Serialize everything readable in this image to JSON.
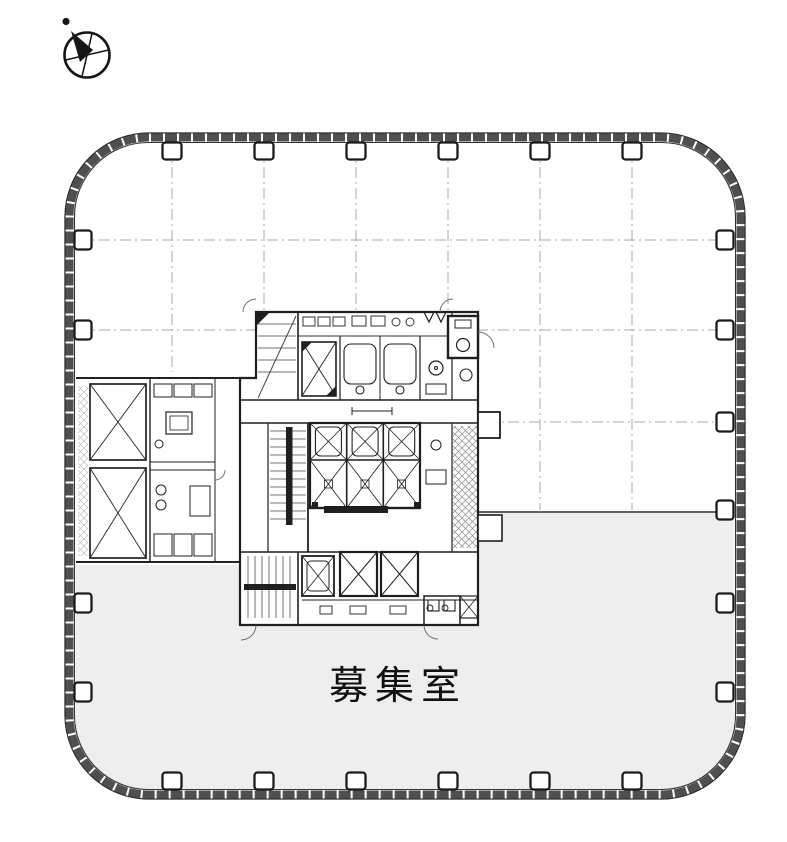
{
  "labels": {
    "available_room": "募集室"
  },
  "icons": {
    "compass": "compass-north-icon"
  },
  "colors": {
    "background": "#ffffff",
    "line": "#1f1f1f",
    "wall_band": "#4f4f4f",
    "grid_line": "#a9a9a9",
    "lease_fill": "#eeeeee",
    "label_text": "#111111"
  },
  "floor_plan": {
    "perimeter_columns": {
      "top": 6,
      "bottom": 6,
      "left": 4,
      "right": 6
    },
    "core": {
      "central_elevators": 6,
      "lower_elevators": 3,
      "stairwells": 3,
      "machine_rooms": 2
    }
  }
}
